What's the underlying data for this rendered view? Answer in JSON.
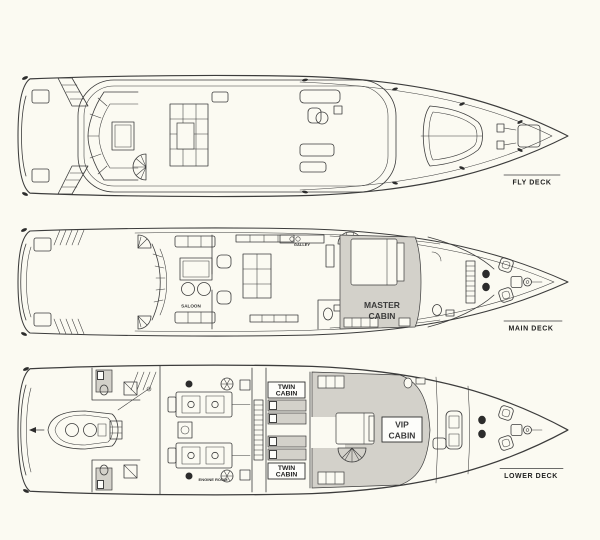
{
  "figure": {
    "background": "#fbfaf2",
    "ink": "#3c3c3c",
    "shade": "#d3d1ca",
    "dark": "#2c2c2c"
  },
  "decks": [
    {
      "id": "fly",
      "label": "FLY DECK"
    },
    {
      "id": "main",
      "label": "MAIN DECK"
    },
    {
      "id": "lower",
      "label": "LOWER DECK"
    }
  ],
  "rooms": {
    "saloon": "SALOON",
    "galley": "GALLEY",
    "master_cabin": [
      "MASTER",
      "CABIN"
    ],
    "twin_cabin_port": [
      "TWIN",
      "CABIN"
    ],
    "twin_cabin_starboard": [
      "TWIN",
      "CABIN"
    ],
    "vip_cabin": [
      "VIP",
      "CABIN"
    ],
    "engine_room": "ENGINE ROOM"
  }
}
